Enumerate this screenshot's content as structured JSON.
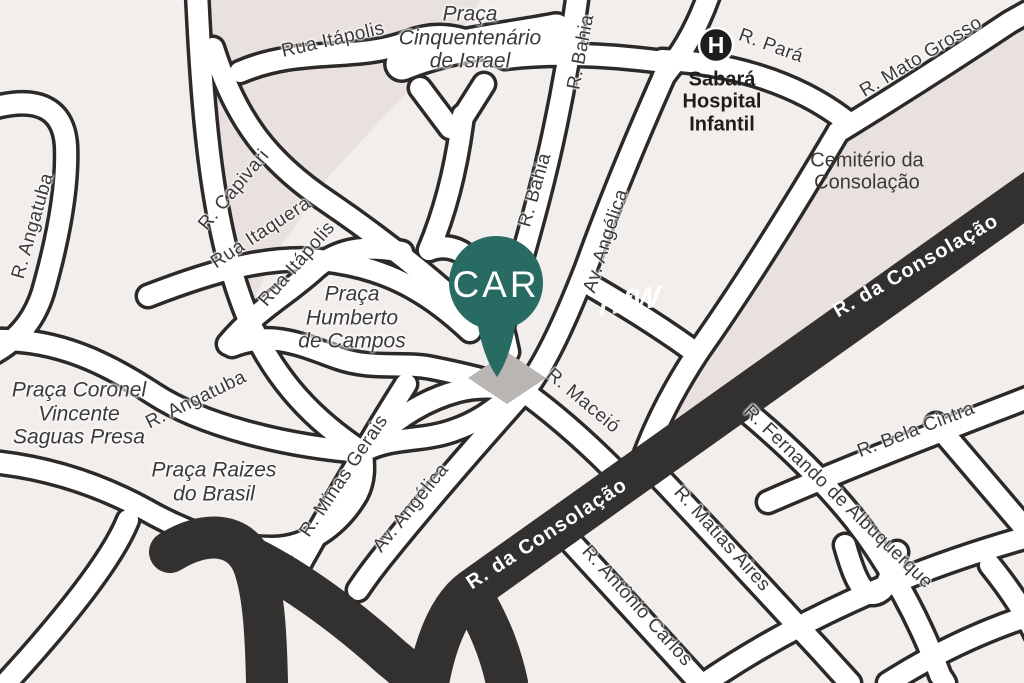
{
  "map": {
    "title": "Illustrated street map - Consolação area",
    "watermark": "HfW",
    "pin": {
      "label": "CAR"
    },
    "hospital": {
      "icon_letter": "H"
    },
    "colors": {
      "background": "#f2eeec",
      "block": "#e9e1de",
      "road_casing": "#2b2a29",
      "road_fill": "#ffffff",
      "major_road": "#333130",
      "pin_teal": "#286b63",
      "pin_shadow": "#b9b5b2",
      "label_dark": "#3c3a39"
    },
    "labels": [
      {
        "name": "label-rua-itapolis-top",
        "style": "street",
        "lines": [
          "Rua Itápolis"
        ],
        "x": 333,
        "y": 40,
        "rot": -13
      },
      {
        "name": "label-r-capivari",
        "style": "street",
        "lines": [
          "R. Capivari"
        ],
        "x": 234,
        "y": 190,
        "rot": -50
      },
      {
        "name": "label-rua-itaquera",
        "style": "street",
        "lines": [
          "Rua Itaquera"
        ],
        "x": 261,
        "y": 233,
        "rot": -33
      },
      {
        "name": "label-rua-itapolis-2",
        "style": "street",
        "lines": [
          "Rua Itápolis"
        ],
        "x": 297,
        "y": 264,
        "rot": -49
      },
      {
        "name": "label-r-angatuba-left",
        "style": "street",
        "lines": [
          "R. Angatuba"
        ],
        "x": 33,
        "y": 226,
        "rot": -74
      },
      {
        "name": "label-r-angatuba-mid",
        "style": "street",
        "lines": [
          "R. Angatuba"
        ],
        "x": 196,
        "y": 400,
        "rot": -26
      },
      {
        "name": "label-r-bahia-top",
        "style": "street",
        "lines": [
          "R. Bahia"
        ],
        "x": 581,
        "y": 52,
        "rot": -79
      },
      {
        "name": "label-r-bahia-mid",
        "style": "street",
        "lines": [
          "R. Bahia"
        ],
        "x": 535,
        "y": 190,
        "rot": -74
      },
      {
        "name": "label-av-angelica-top",
        "style": "street",
        "lines": [
          "Av. Angélica"
        ],
        "x": 606,
        "y": 241,
        "rot": -72
      },
      {
        "name": "label-av-angelica-low",
        "style": "street",
        "lines": [
          "Av. Angélica"
        ],
        "x": 411,
        "y": 508,
        "rot": -51
      },
      {
        "name": "label-r-minas-gerais",
        "style": "street",
        "lines": [
          "R. Minas Gerais"
        ],
        "x": 344,
        "y": 476,
        "rot": -56
      },
      {
        "name": "label-r-maceio",
        "style": "street",
        "lines": [
          "R. Maceió"
        ],
        "x": 583,
        "y": 401,
        "rot": 40
      },
      {
        "name": "label-r-para",
        "style": "street",
        "lines": [
          "R. Pará"
        ],
        "x": 771,
        "y": 46,
        "rot": 20
      },
      {
        "name": "label-r-mato-grosso",
        "style": "street",
        "lines": [
          "R. Mato Grosso"
        ],
        "x": 921,
        "y": 57,
        "rot": -31
      },
      {
        "name": "label-r-fernando",
        "style": "street",
        "lines": [
          "R. Fernando de Albuquerque"
        ],
        "x": 838,
        "y": 497,
        "rot": 44
      },
      {
        "name": "label-r-bela-cintra",
        "style": "street",
        "lines": [
          "R. Bela Cintra"
        ],
        "x": 916,
        "y": 430,
        "rot": -21
      },
      {
        "name": "label-r-matias-aires",
        "style": "street",
        "lines": [
          "R. Matias Aires"
        ],
        "x": 722,
        "y": 539,
        "rot": 48
      },
      {
        "name": "label-r-antonio-carlos",
        "style": "street",
        "lines": [
          "R. Antônio Carlos"
        ],
        "x": 637,
        "y": 606,
        "rot": 48
      },
      {
        "name": "label-consolacao-upper",
        "style": "road-dark",
        "lines": [
          "R. da Consolação"
        ],
        "x": 916,
        "y": 266,
        "rot": -30
      },
      {
        "name": "label-consolacao-lower",
        "style": "road-dark",
        "lines": [
          "R. da Consolação"
        ],
        "x": 547,
        "y": 534,
        "rot": -33
      },
      {
        "name": "label-praca-cinquentenario",
        "style": "place",
        "lines": [
          "Praça",
          "Cinquentenário",
          "de Israel"
        ],
        "x": 470,
        "y": 38,
        "rot": 0
      },
      {
        "name": "label-praca-humberto",
        "style": "place",
        "lines": [
          "Praça",
          "Humberto",
          "de Campos"
        ],
        "x": 352,
        "y": 318,
        "rot": 0
      },
      {
        "name": "label-praca-coronel",
        "style": "place",
        "lines": [
          "Praça Coronel",
          "Vincente",
          "Saguas Presa"
        ],
        "x": 79,
        "y": 414,
        "rot": 0
      },
      {
        "name": "label-praca-raizes",
        "style": "place",
        "lines": [
          "Praça Raizes",
          "do Brasil"
        ],
        "x": 214,
        "y": 482,
        "rot": 0
      },
      {
        "name": "label-cemiterio",
        "style": "area",
        "lines": [
          "Cemitério da",
          "Consolação"
        ],
        "x": 867,
        "y": 172,
        "rot": 0
      },
      {
        "name": "label-hospital",
        "style": "hospital",
        "lines": [
          "Sabará",
          "Hospital",
          "Infantil"
        ],
        "x": 722,
        "y": 102,
        "rot": 0
      }
    ]
  }
}
